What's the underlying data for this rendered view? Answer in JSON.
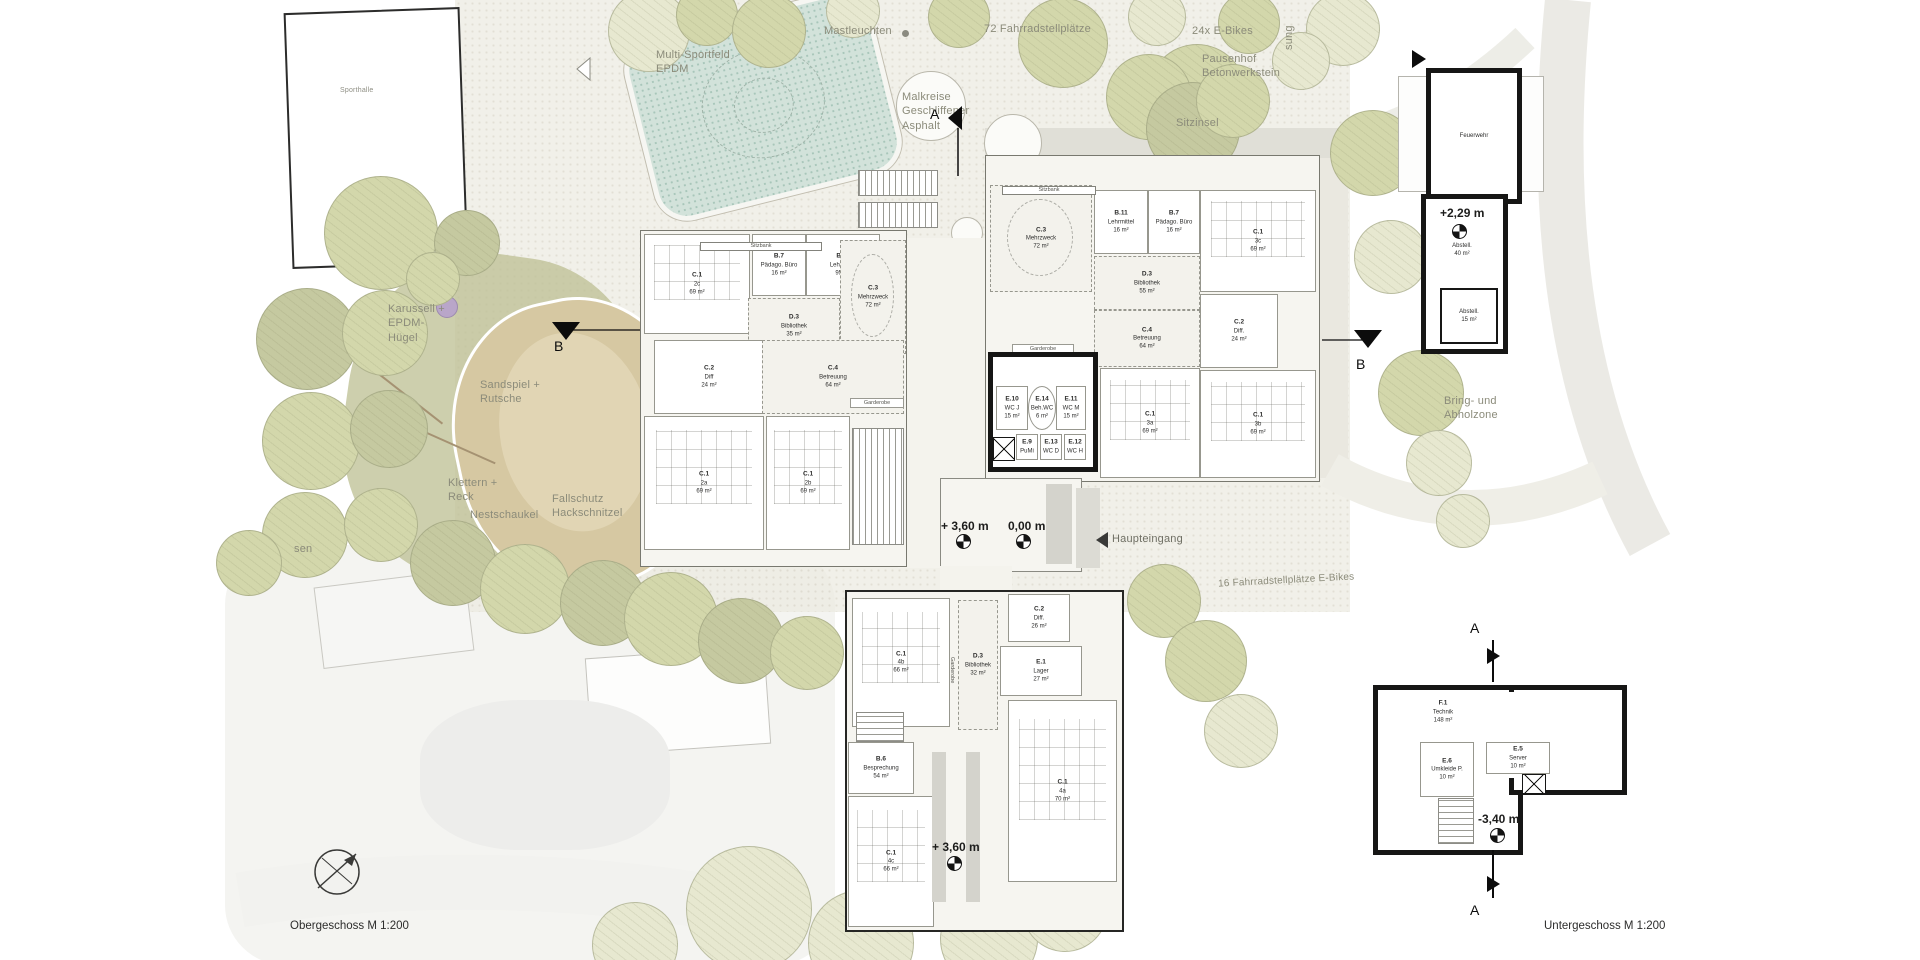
{
  "captions": {
    "left": "Obergeschoss M 1:200",
    "right": "Untergeschoss M 1:200"
  },
  "site": {
    "sporthalle": "Sporthalle",
    "multisport": "Multi-Sportfeld\nEPDM",
    "mastleuchten": "Mastleuchten",
    "fahrrad72": "72  Fahrradstellplätze",
    "ebikes24": "24x  E-Bikes",
    "pausenhof": "Pausenhof\nBetonwerkstein",
    "malkreise": "Malkreise\nGeschliffener\nAsphalt",
    "sitzinsel": "Sitzinsel",
    "anlieferung_partial": "sung",
    "karussell": "Karussell +\nEPDM-\nHügel",
    "sandspiel": "Sandspiel +\nRutsche",
    "klettern": "Klettern +\nReck",
    "nestschaukel": "Nestschaukel",
    "fallschutz": "Fallschutz\nHackschnitzel",
    "rasen_partial": "sen",
    "haupteingang": "Haupteingang",
    "bringzone": "Bring- und\nAbholzone",
    "fahrrad16": "16  Fahrradstellplätze  E-Bikes",
    "sitzbank": "Sitzbank",
    "garderobe": "Garderobe"
  },
  "levels": {
    "entry_upper": "+ 3,60 m",
    "entry_zero": "0,00 m",
    "lower_wing": "+ 3,60 m",
    "fire": "+2,29 m",
    "basement": "-3,40 m"
  },
  "sections": {
    "a": "A",
    "b": "B"
  },
  "rooms": {
    "west": [
      {
        "id": "C.1",
        "name": "2c",
        "area": "69 m²"
      },
      {
        "id": "B.7",
        "name": "Pädago. Büro",
        "area": "16 m²"
      },
      {
        "id": "B.11",
        "name": "Lehrmittel",
        "area": "95 m²"
      },
      {
        "id": "D.3",
        "name": "Bibliothek",
        "area": "35 m²"
      },
      {
        "id": "C.3",
        "name": "Mehrzweck",
        "area": "72 m²"
      },
      {
        "id": "C.2",
        "name": "Diff",
        "area": "24 m²"
      },
      {
        "id": "C.4",
        "name": "Betreuung",
        "area": "64 m²"
      },
      {
        "id": "C.1",
        "name": "2a",
        "area": "69 m²"
      },
      {
        "id": "C.1",
        "name": "2b",
        "area": "69 m²"
      }
    ],
    "east": [
      {
        "id": "C.3",
        "name": "Mehrzweck",
        "area": "72 m²"
      },
      {
        "id": "B.11",
        "name": "Lehrmittel",
        "area": "16 m²"
      },
      {
        "id": "B.7",
        "name": "Pädago. Büro",
        "area": "16 m²"
      },
      {
        "id": "C.1",
        "name": "3c",
        "area": "69 m²"
      },
      {
        "id": "D.3",
        "name": "Bibliothek",
        "area": "55 m²"
      },
      {
        "id": "C.4",
        "name": "Betreuung",
        "area": "64 m²"
      },
      {
        "id": "C.2",
        "name": "Diff.",
        "area": "24 m²"
      },
      {
        "id": "C.1",
        "name": "3a",
        "area": "69 m²"
      },
      {
        "id": "C.1",
        "name": "3b",
        "area": "69 m²"
      }
    ],
    "wc": [
      {
        "id": "E.10",
        "name": "WC J",
        "area": "15 m²"
      },
      {
        "id": "E.14",
        "name": "Beh.WC",
        "area": "6 m²"
      },
      {
        "id": "E.11",
        "name": "WC M",
        "area": "15 m²"
      },
      {
        "id": "E.9",
        "name": "PuMi",
        "area": "4 m²"
      },
      {
        "id": "E.13",
        "name": "WC D",
        "area": "4 m²"
      },
      {
        "id": "E.12",
        "name": "WC H",
        "area": "4 m²"
      }
    ],
    "lower": [
      {
        "id": "C.1",
        "name": "4b",
        "area": "66 m²"
      },
      {
        "id": "D.3",
        "name": "Bibliothek",
        "area": "32 m²"
      },
      {
        "id": "C.2",
        "name": "Diff.",
        "area": "26 m²"
      },
      {
        "id": "E.1",
        "name": "Lager",
        "area": "27 m²"
      },
      {
        "id": "C.1",
        "name": "4a",
        "area": "70 m²"
      },
      {
        "id": "B.6",
        "name": "Besprechung",
        "area": "54 m²"
      },
      {
        "id": "C.1",
        "name": "4c",
        "area": "66 m²"
      }
    ],
    "fire": [
      {
        "id": "",
        "name": "Feuerwehr",
        "area": ""
      },
      {
        "id": "",
        "name": "Abstell.",
        "area": "40 m²"
      },
      {
        "id": "",
        "name": "Abstell.",
        "area": "15 m²"
      }
    ],
    "base": [
      {
        "id": "F.1",
        "name": "Technik",
        "area": "148 m²"
      },
      {
        "id": "E.6",
        "name": "Umkleide P.",
        "area": "10 m²"
      },
      {
        "id": "E.5",
        "name": "Server",
        "area": "10 m²"
      }
    ]
  }
}
